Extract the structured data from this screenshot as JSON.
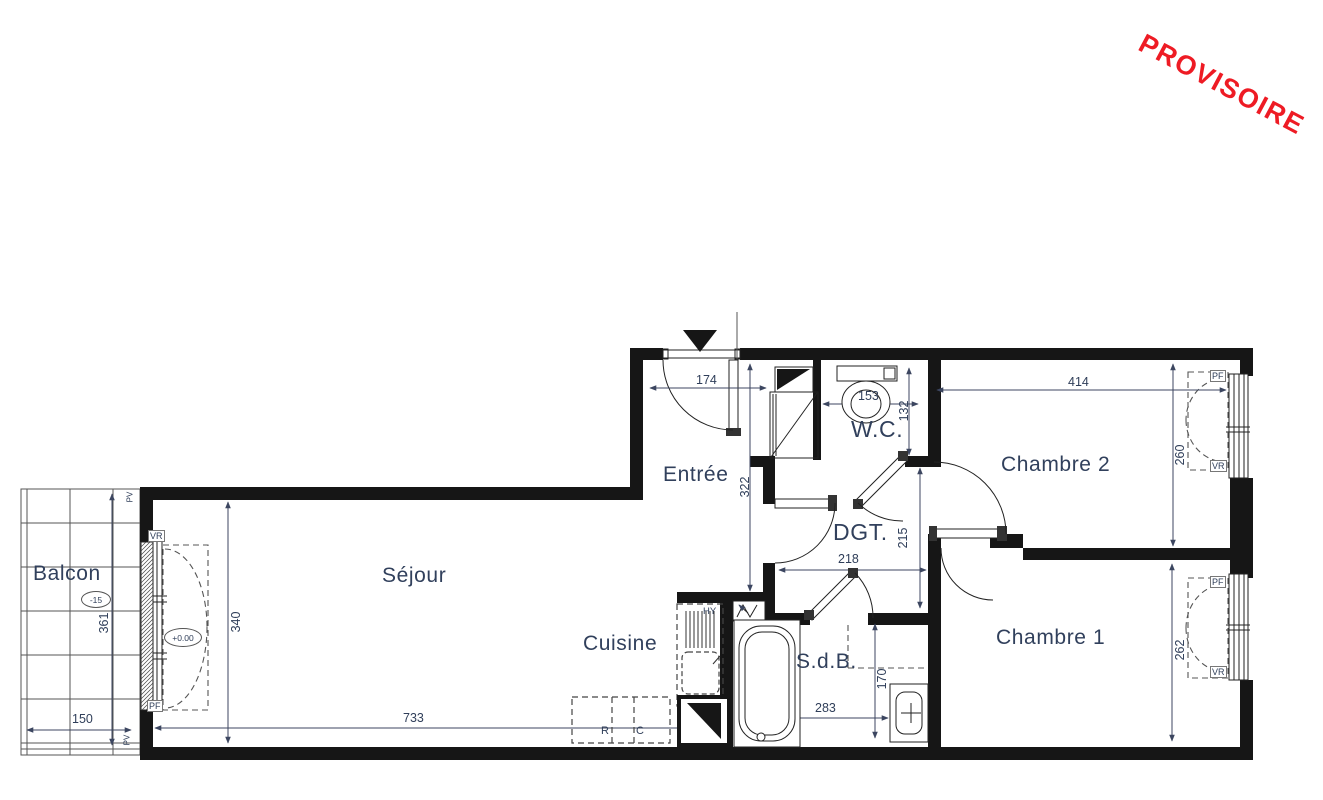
{
  "stamp": {
    "text": "PROVISOIRE",
    "color": "#ee1b24"
  },
  "rooms": {
    "balcon": {
      "label": "Balcon"
    },
    "sejour": {
      "label": "Séjour"
    },
    "cuisine": {
      "label": "Cuisine"
    },
    "entree": {
      "label": "Entrée"
    },
    "wc": {
      "label": "W.C."
    },
    "dgt": {
      "label": "DGT."
    },
    "sdb": {
      "label": "S.d.B."
    },
    "chambre1": {
      "label": "Chambre 1"
    },
    "chambre2": {
      "label": "Chambre 2"
    }
  },
  "dims": {
    "entree_w": "174",
    "entree_d": "322",
    "wc_w": "153",
    "wc_d": "132",
    "ch2_w": "414",
    "ch2_d": "260",
    "dgt_w": "218",
    "dgt_d": "215",
    "sejour_d": "340",
    "sejour_w": "733",
    "balcon_d": "361",
    "balcon_w": "150",
    "sdb_w": "283",
    "sdb_d": "170",
    "ch1_d": "262"
  },
  "tags": {
    "pf": "PF",
    "vr": "VR",
    "pv": "PV",
    "hy": "HY"
  },
  "appliances": {
    "fridge": "R",
    "cooker": "C"
  },
  "elevations": {
    "balcon": "-15",
    "interior": "+0.00"
  },
  "colors": {
    "wall": "#161616",
    "line": "#222222",
    "dim": "#3c4660",
    "label": "#31405c"
  }
}
